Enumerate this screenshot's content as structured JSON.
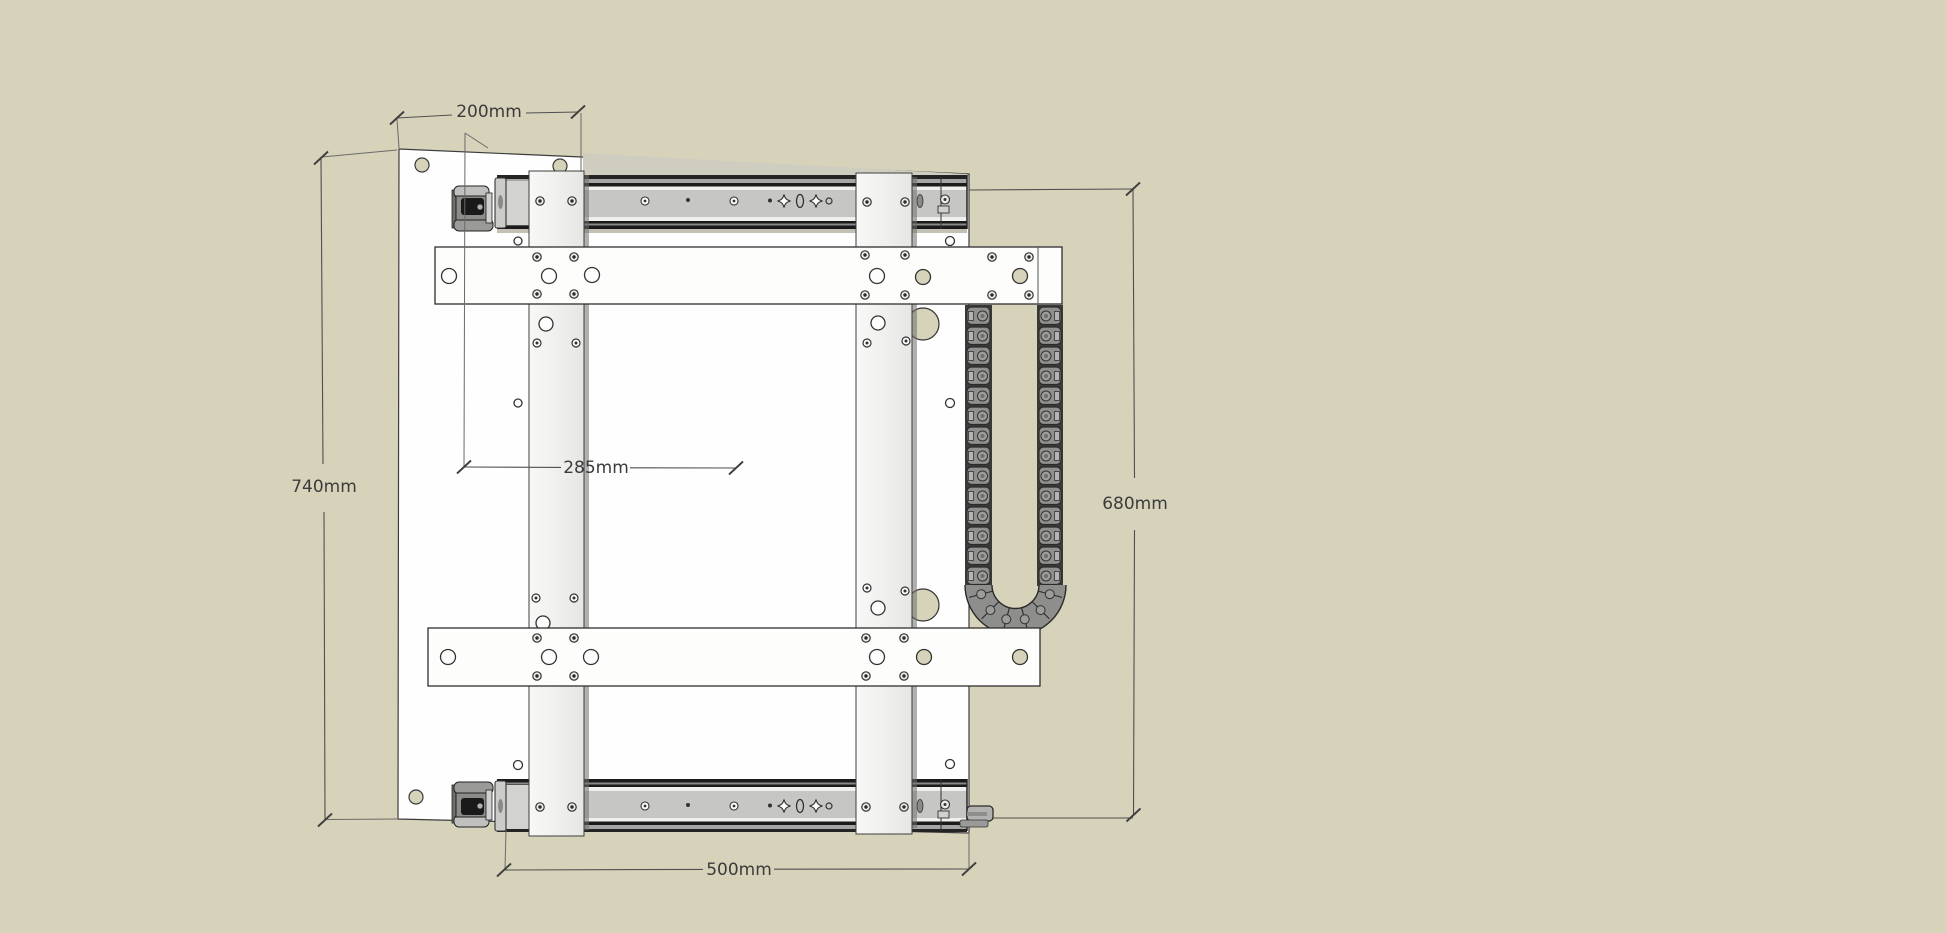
{
  "drawing": {
    "title": "drawer-slide-assembly-technical-drawing",
    "unit": "mm",
    "background_color": "#d6d3ba",
    "panel_color": "#fefefe",
    "rail_body_color": "#c6c6c4",
    "chain_color": "#8e8e8c",
    "line_color": "#4f4f4f",
    "text_color": "#3b3b3b",
    "dimensions": {
      "top_width": "200mm",
      "left_height": "740mm",
      "center_offset": "285mm",
      "right_height": "680mm",
      "bottom_slide_length": "500mm"
    }
  }
}
